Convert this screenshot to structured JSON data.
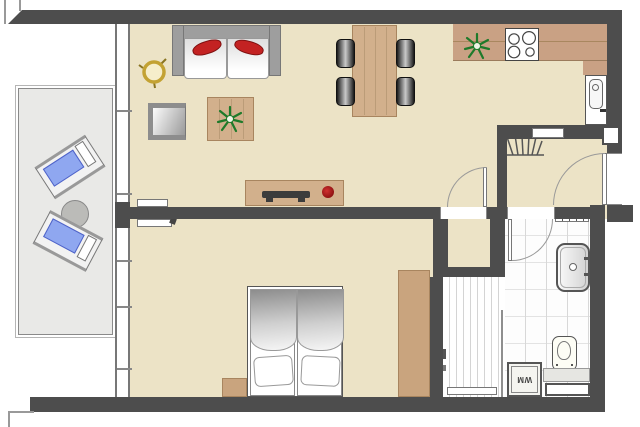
{
  "title": "Apartment floor plan",
  "labels": {
    "washing_machine": "WM"
  },
  "colors": {
    "wall": "#4d4d4d",
    "floor_beige": "#ece3c6",
    "wood": "#d2b08c",
    "kitchen_counter": "#c9a184",
    "wardrobe_brown": "#c9a47e",
    "balcony_floor": "#e9e9e7",
    "lounger_cushion_blue": "#8fa7f0",
    "sofa_pillow_red": "#c32222",
    "plant_green": "#1e7a2a",
    "stool_gold": "#c3a233",
    "tile_line_gray": "#d8d8d8"
  },
  "rooms": {
    "living_room": {
      "furniture": [
        "sofa",
        "red-pillows",
        "round-side-stool",
        "armchair",
        "coffee-table",
        "plant",
        "sideboard",
        "tv",
        "radiator"
      ]
    },
    "dining_area": {
      "furniture": [
        "dining-table",
        "four-chairs"
      ]
    },
    "kitchen": {
      "furniture": [
        "l-counter",
        "cooktop-4-burners",
        "plant",
        "sink-unit"
      ]
    },
    "hallway": {
      "furniture": [
        "coat-rack",
        "wall-shelf",
        "entrance-door"
      ]
    },
    "bedroom": {
      "furniture": [
        "double-bed",
        "two-pillows",
        "nightstand",
        "wardrobe",
        "radiator"
      ]
    },
    "bathroom": {
      "furniture": [
        "washbasin",
        "wall-shelf",
        "toilet",
        "washing-machine",
        "shower",
        "glass-partition",
        "ledge",
        "niche-window"
      ]
    },
    "storage_closet": {
      "furniture": []
    },
    "balcony": {
      "furniture": [
        "two-sun-loungers",
        "round-table"
      ]
    }
  }
}
